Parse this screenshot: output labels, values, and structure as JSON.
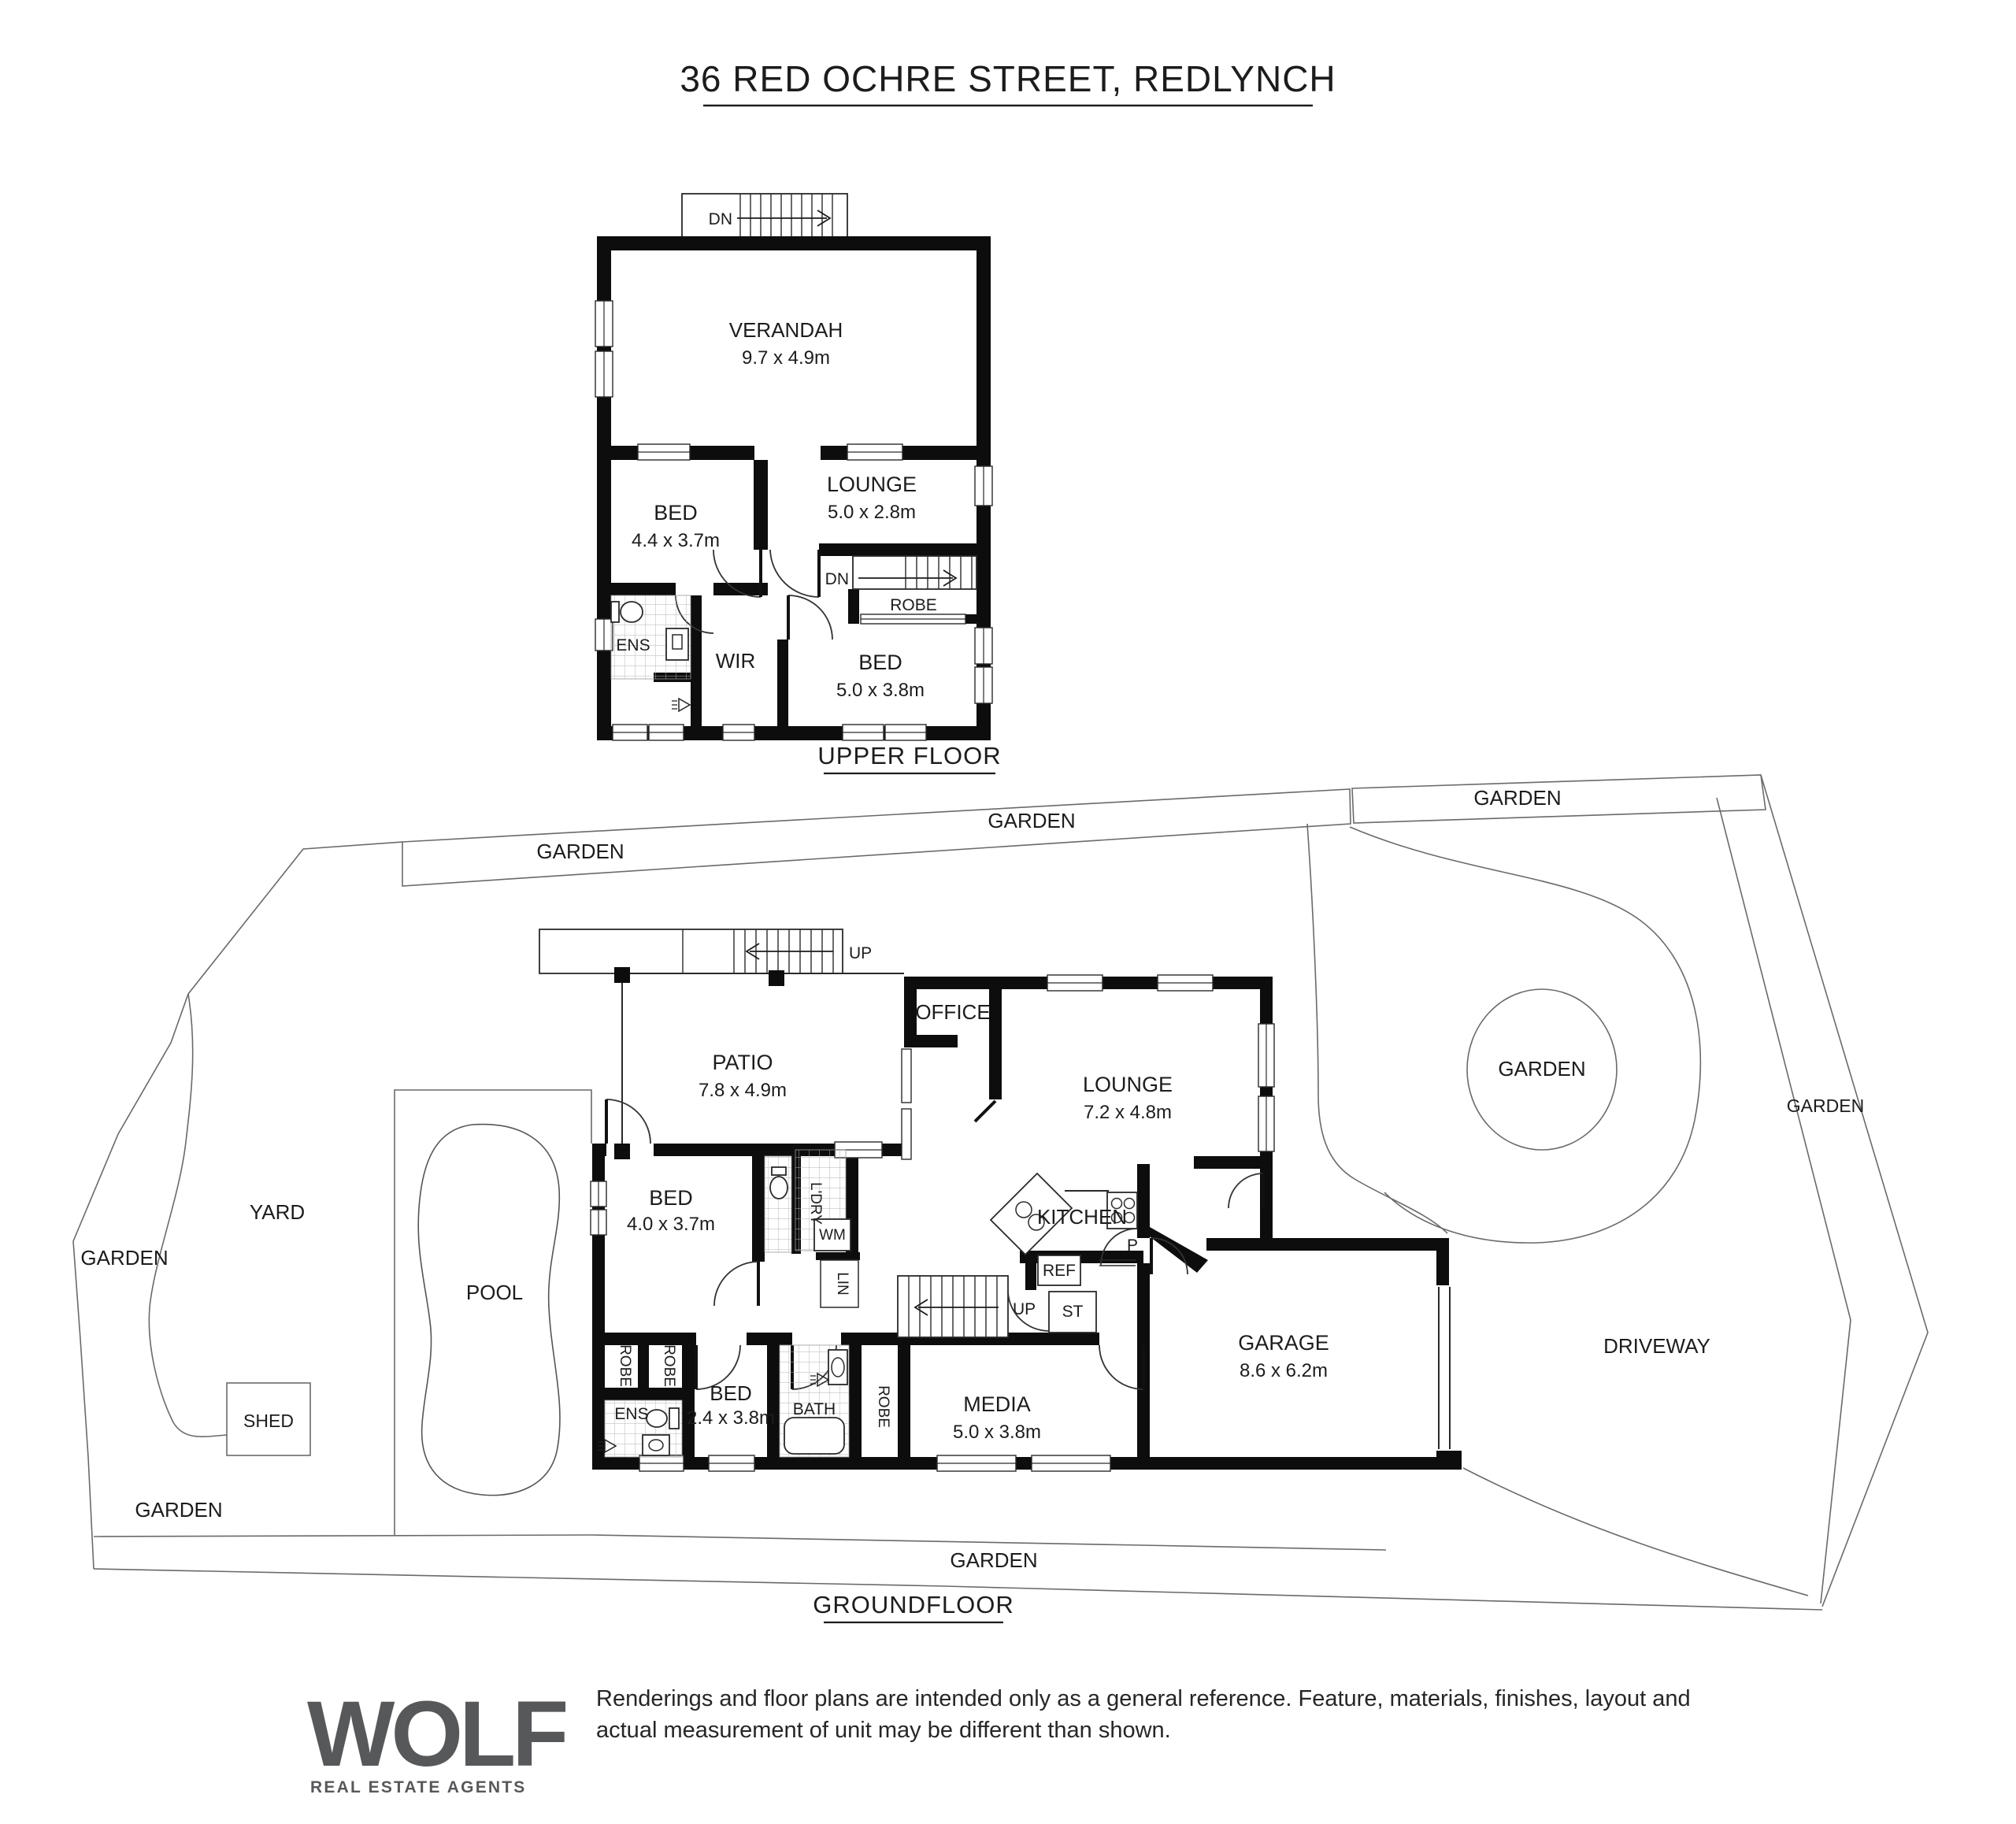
{
  "title": "36 RED OCHRE STREET, REDLYNCH",
  "upper": {
    "caption": "UPPER FLOOR",
    "stairs_top": "DN",
    "stairs_mid": "DN",
    "verandah": {
      "name": "VERANDAH",
      "dims": "9.7 x 4.9m"
    },
    "bed1": {
      "name": "BED",
      "dims": "4.4 x 3.7m"
    },
    "lounge": {
      "name": "LOUNGE",
      "dims": "5.0 x 2.8m"
    },
    "bed2": {
      "name": "BED",
      "dims": "5.0 x 3.8m"
    },
    "robe": "ROBE",
    "ens": "ENS",
    "wir": "WIR"
  },
  "ground": {
    "caption": "GROUNDFLOOR",
    "stairs_top": "UP",
    "stairs_mid": "UP",
    "patio": {
      "name": "PATIO",
      "dims": "7.8 x 4.9m"
    },
    "office": "OFFICE",
    "lounge": {
      "name": "LOUNGE",
      "dims": "7.2 x 4.8m"
    },
    "kitchen": "KITCHEN",
    "pantry": "P",
    "fridge": "REF",
    "store": "ST",
    "bed3": {
      "name": "BED",
      "dims": "4.0 x 3.7m"
    },
    "laundry": "L'DRY",
    "wm": "WM",
    "linen": "LIN",
    "robe1": "ROBE",
    "robe2": "ROBE",
    "robe3": "ROBE",
    "ens": "ENS",
    "bed4": {
      "name": "BED",
      "dims": "2.4 x 3.8m"
    },
    "bath": "BATH",
    "media": {
      "name": "MEDIA",
      "dims": "5.0 x 3.8m"
    },
    "garage": {
      "name": "GARAGE",
      "dims": "8.6 x 6.2m"
    }
  },
  "site": {
    "gardens": [
      "GARDEN",
      "GARDEN",
      "GARDEN",
      "GARDEN",
      "GARDEN",
      "GARDEN",
      "GARDEN",
      "GARDEN"
    ],
    "yard": "YARD",
    "pool": "POOL",
    "shed": "SHED",
    "driveway": "DRIVEWAY"
  },
  "footer": {
    "logo": "WOLF",
    "logo_sub": "REAL ESTATE AGENTS",
    "disclaimer_1": "Renderings and floor plans are intended only as a general reference. Feature, materials, finishes, layout and",
    "disclaimer_2": "actual measurement of unit may be different than shown."
  }
}
